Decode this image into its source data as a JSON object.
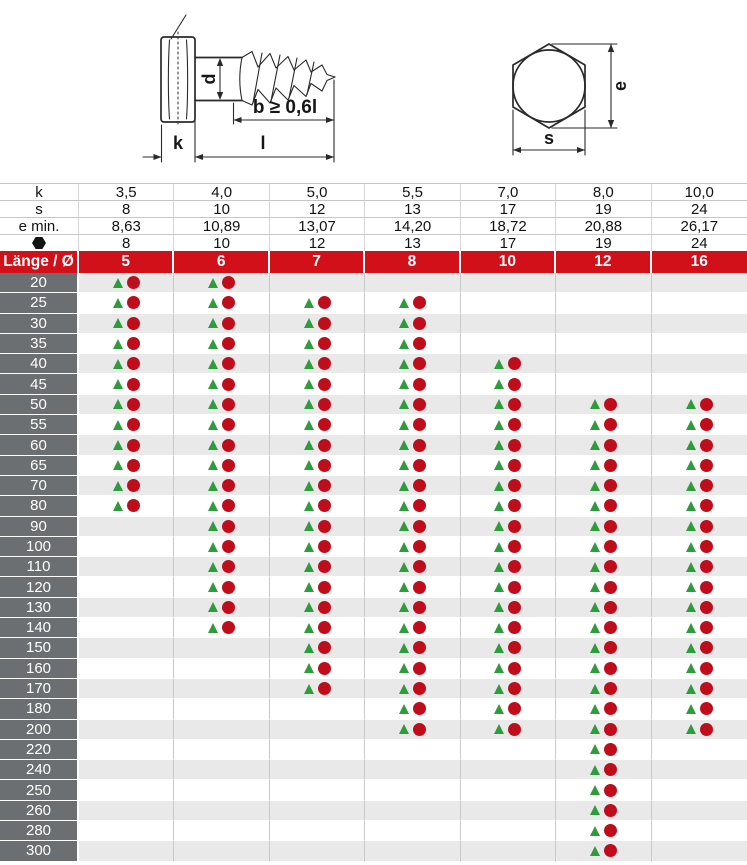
{
  "drawing": {
    "side_labels": {
      "d": "d",
      "b": "b ≥ 0,6l",
      "k": "k",
      "l": "l"
    },
    "top_labels": {
      "e": "e",
      "s": "s"
    }
  },
  "colors": {
    "header_red": "#d21019",
    "label_gray": "#6c6f71",
    "stripe_gray": "#e9e9e9",
    "grid_line": "#c9c9c9",
    "triangle_green": "#2e9b3c",
    "dot_red": "#c00d1c",
    "drawing_ink": "#2a2a2a"
  },
  "spec_rows": [
    {
      "label": "k",
      "icon": "",
      "values": [
        "3,5",
        "4,0",
        "5,0",
        "5,5",
        "7,0",
        "8,0",
        "10,0"
      ]
    },
    {
      "label": "s",
      "icon": "",
      "values": [
        "8",
        "10",
        "12",
        "13",
        "17",
        "19",
        "24"
      ]
    },
    {
      "label": "e min.",
      "icon": "",
      "values": [
        "8,63",
        "10,89",
        "13,07",
        "14,20",
        "18,72",
        "20,88",
        "26,17"
      ]
    },
    {
      "label": "",
      "icon": "hex-icon",
      "values": [
        "8",
        "10",
        "12",
        "13",
        "17",
        "19",
        "24"
      ]
    }
  ],
  "header": {
    "label": "Länge / Ø",
    "diameters": [
      "5",
      "6",
      "7",
      "8",
      "10",
      "12",
      "16"
    ]
  },
  "rows": [
    {
      "length": "20",
      "marks": [
        1,
        1,
        0,
        0,
        0,
        0,
        0
      ]
    },
    {
      "length": "25",
      "marks": [
        1,
        1,
        1,
        1,
        0,
        0,
        0
      ]
    },
    {
      "length": "30",
      "marks": [
        1,
        1,
        1,
        1,
        0,
        0,
        0
      ]
    },
    {
      "length": "35",
      "marks": [
        1,
        1,
        1,
        1,
        0,
        0,
        0
      ]
    },
    {
      "length": "40",
      "marks": [
        1,
        1,
        1,
        1,
        1,
        0,
        0
      ]
    },
    {
      "length": "45",
      "marks": [
        1,
        1,
        1,
        1,
        1,
        0,
        0
      ]
    },
    {
      "length": "50",
      "marks": [
        1,
        1,
        1,
        1,
        1,
        1,
        1
      ]
    },
    {
      "length": "55",
      "marks": [
        1,
        1,
        1,
        1,
        1,
        1,
        1
      ]
    },
    {
      "length": "60",
      "marks": [
        1,
        1,
        1,
        1,
        1,
        1,
        1
      ]
    },
    {
      "length": "65",
      "marks": [
        1,
        1,
        1,
        1,
        1,
        1,
        1
      ]
    },
    {
      "length": "70",
      "marks": [
        1,
        1,
        1,
        1,
        1,
        1,
        1
      ]
    },
    {
      "length": "80",
      "marks": [
        1,
        1,
        1,
        1,
        1,
        1,
        1
      ]
    },
    {
      "length": "90",
      "marks": [
        0,
        1,
        1,
        1,
        1,
        1,
        1
      ]
    },
    {
      "length": "100",
      "marks": [
        0,
        1,
        1,
        1,
        1,
        1,
        1
      ]
    },
    {
      "length": "110",
      "marks": [
        0,
        1,
        1,
        1,
        1,
        1,
        1
      ]
    },
    {
      "length": "120",
      "marks": [
        0,
        1,
        1,
        1,
        1,
        1,
        1
      ]
    },
    {
      "length": "130",
      "marks": [
        0,
        1,
        1,
        1,
        1,
        1,
        1
      ]
    },
    {
      "length": "140",
      "marks": [
        0,
        1,
        1,
        1,
        1,
        1,
        1
      ]
    },
    {
      "length": "150",
      "marks": [
        0,
        0,
        1,
        1,
        1,
        1,
        1
      ]
    },
    {
      "length": "160",
      "marks": [
        0,
        0,
        1,
        1,
        1,
        1,
        1
      ]
    },
    {
      "length": "170",
      "marks": [
        0,
        0,
        1,
        1,
        1,
        1,
        1
      ]
    },
    {
      "length": "180",
      "marks": [
        0,
        0,
        0,
        1,
        1,
        1,
        1
      ]
    },
    {
      "length": "200",
      "marks": [
        0,
        0,
        0,
        1,
        1,
        1,
        1
      ]
    },
    {
      "length": "220",
      "marks": [
        0,
        0,
        0,
        0,
        0,
        1,
        0
      ]
    },
    {
      "length": "240",
      "marks": [
        0,
        0,
        0,
        0,
        0,
        1,
        0
      ]
    },
    {
      "length": "250",
      "marks": [
        0,
        0,
        0,
        0,
        0,
        1,
        0
      ]
    },
    {
      "length": "260",
      "marks": [
        0,
        0,
        0,
        0,
        0,
        1,
        0
      ]
    },
    {
      "length": "280",
      "marks": [
        0,
        0,
        0,
        0,
        0,
        1,
        0
      ]
    },
    {
      "length": "300",
      "marks": [
        0,
        0,
        0,
        0,
        0,
        1,
        0
      ]
    }
  ]
}
